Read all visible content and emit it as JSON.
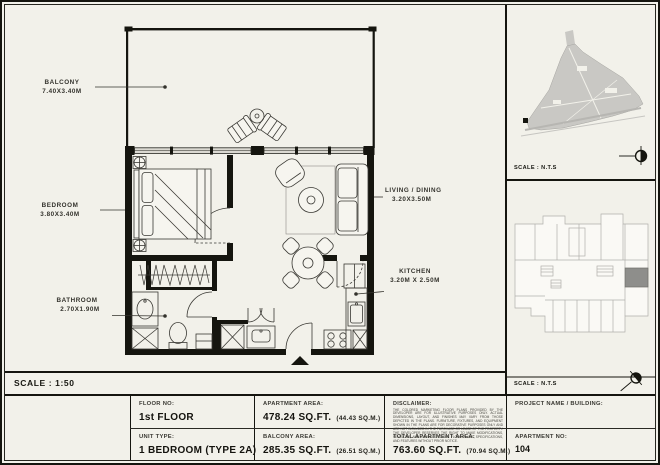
{
  "sheet": {
    "plan_scale": "SCALE : 1:50",
    "rooms": {
      "balcony": {
        "name": "BALCONY",
        "dims": "7.40X3.40M"
      },
      "bedroom": {
        "name": "BEDROOM",
        "dims": "3.80X3.40M"
      },
      "bathroom": {
        "name": "BATHROOM",
        "dims": "2.70X1.90M"
      },
      "living": {
        "name": "LIVING / DINING",
        "dims": "3.20X3.50M"
      },
      "kitchen": {
        "name": "KITCHEN",
        "dims": "3.20M X 2.50M"
      }
    },
    "masterplan": {
      "scale": "SCALE : N.T.S",
      "icon": "north-arrow-icon"
    },
    "keyplan": {
      "scale": "SCALE : N.T.S",
      "icon": "north-arrow-icon"
    },
    "titleblock": {
      "floor": {
        "label": "FLOOR NO:",
        "value": "1st FLOOR"
      },
      "unit": {
        "label": "UNIT TYPE:",
        "value": "1 BEDROOM (TYPE 2A)"
      },
      "apartment_area": {
        "label": "APARTMENT AREA:",
        "value": "478.24 SQ.FT.",
        "metric": "(44.43 SQ.M.)"
      },
      "balcony_area": {
        "label": "BALCONY AREA:",
        "value": "285.35 SQ.FT.",
        "metric": "(26.51 SQ.M.)"
      },
      "total_area": {
        "label": "TOTAL APARTMENT AREA:",
        "value": "763.60 SQ.FT.",
        "metric": "(70.94 SQ.M.)"
      },
      "project": {
        "label": "PROJECT NAME / BUILDING:",
        "value": ""
      },
      "apartment_no": {
        "label": "APARTMENT NO:",
        "value": "104"
      },
      "disclaimer": {
        "label": "DISCLAIMER:",
        "text": "THE COLORED MARKETING FLOOR PLANS PROVIDED BY THE DEVELOPER ARE FOR ILLUSTRATIVE PURPOSES ONLY. ACTUAL DIMENSIONS, LAYOUT, AND FINISHES MAY VARY FROM THOSE DEPICTED IN THE PLANS. FURNITURE, FIXTURES, AND EQUIPMENT SHOWN IN THE PLANS ARE FOR DECORATIVE PURPOSES ONLY AND ARE NOT INCLUDED IN THE PURCHASE OR LEASE OF THE PROPERTY. THE DEVELOPER RESERVES THE RIGHT TO MAKE MODIFICATIONS, REVISIONS, AND CHANGES TO THE FLOOR PLANS, SPECIFICATIONS, AND FEATURES WITHOUT PRIOR NOTICE."
      }
    },
    "colors": {
      "paper": "#f2f1ea",
      "ink": "#15150f",
      "map_fill": "#c9c8c4",
      "unit_highlight": "#8e8e8b"
    }
  }
}
